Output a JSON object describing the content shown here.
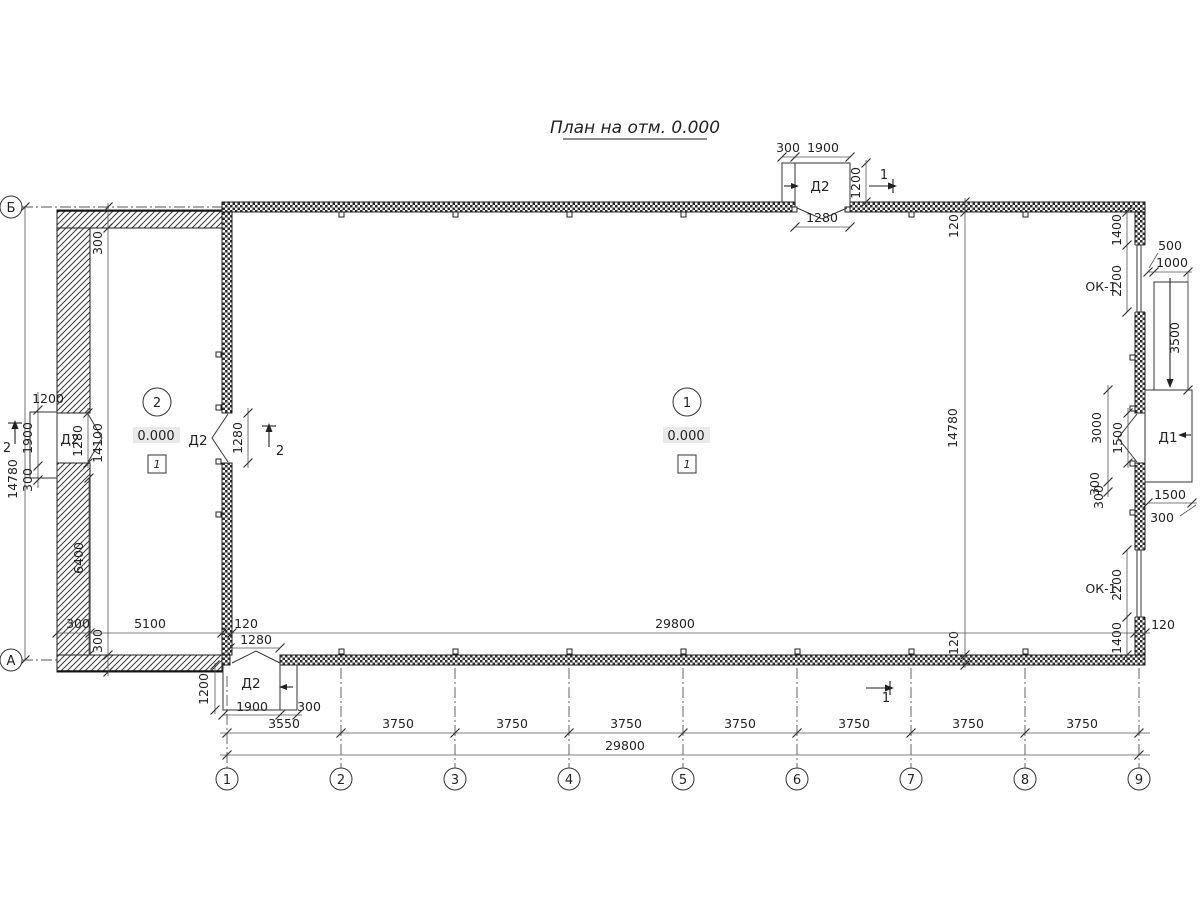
{
  "title": "План на отм. 0.000",
  "axes": {
    "cols": [
      "1",
      "2",
      "3",
      "4",
      "5",
      "6",
      "7",
      "8",
      "9"
    ],
    "row_top": "Б",
    "row_bottom": "А"
  },
  "bottom": {
    "spacings": [
      "3550",
      "3750",
      "3750",
      "3750",
      "3750",
      "3750",
      "3750",
      "3750"
    ],
    "total": "29800"
  },
  "rooms": {
    "r1": {
      "num": "1",
      "level": "0.000",
      "floor": "1"
    },
    "r2": {
      "num": "2",
      "level": "0.000",
      "floor": "1"
    }
  },
  "doors": {
    "top": {
      "name": "Д2",
      "w300": "300",
      "w1900": "1900",
      "d1200": "1200",
      "open": "1280"
    },
    "left": {
      "name": "Д2",
      "d1200": "1200",
      "w1900": "1900",
      "w300": "300",
      "open": "1280"
    },
    "mid": {
      "name": "Д2",
      "open": "1280"
    },
    "bottom": {
      "name": "Д2",
      "open": "1280",
      "d1200": "1200",
      "w1900": "1900",
      "w300": "300"
    },
    "d1": {
      "name": "Д1",
      "open1500": "1500",
      "porch3000": "3000",
      "p300a": "300",
      "p300b": "300",
      "below1500": "1500",
      "below300": "300"
    }
  },
  "windows": {
    "top": {
      "name": "ОК-1",
      "off1400": "1400",
      "len2200": "2200"
    },
    "bottom": {
      "name": "ОК-1",
      "len2200": "2200",
      "off1400": "1400"
    }
  },
  "ramp": {
    "w500": "500",
    "w1000": "1000",
    "len3500": "3500"
  },
  "dims": {
    "left14780": "14780",
    "right14780": "14780",
    "top120": "120",
    "bottom120": "120",
    "rwall120": "120",
    "a300top": "300",
    "a14100": "14100",
    "a6400": "6400",
    "a300b": "300",
    "h300": "300",
    "h5100": "5100",
    "h120": "120",
    "inner29800": "29800"
  },
  "sections": {
    "s1a": "1",
    "s1b": "1",
    "s2a": "2",
    "s2b": "2"
  }
}
